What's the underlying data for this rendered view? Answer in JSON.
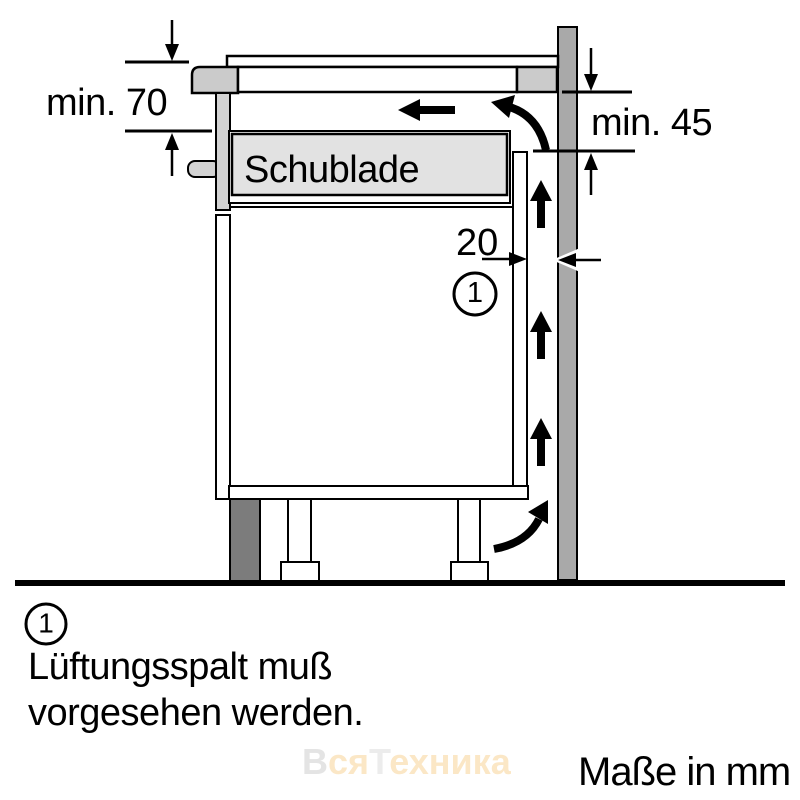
{
  "diagram": {
    "type": "appliance installation side-section drawing",
    "drawer_label": "Schublade",
    "dimensions": {
      "top_clearance": "min. 70",
      "rear_clearance": "min. 45",
      "vent_gap": "20"
    },
    "callout_number": "1",
    "units_note": "Maße in mm",
    "colors": {
      "line": "#000000",
      "worktop": "#cbcbcb",
      "front_panel": "#d3d3d3",
      "drawer_fill": "#e2e2e2",
      "wall": "#a9a9a9",
      "plinth": "#7c7c7c",
      "background": "#ffffff"
    }
  },
  "legend": {
    "number": "1",
    "line1": "Lüftungsspalt muß",
    "line2": "vorgesehen werden."
  },
  "watermark": {
    "segments": [
      {
        "text": "В",
        "color": "#e4e4e4"
      },
      {
        "text": "ся",
        "color": "#fbe7c6"
      },
      {
        "text": "Т",
        "color": "#ececec"
      },
      {
        "text": "ехника",
        "color": "#fbe7c6"
      }
    ]
  }
}
